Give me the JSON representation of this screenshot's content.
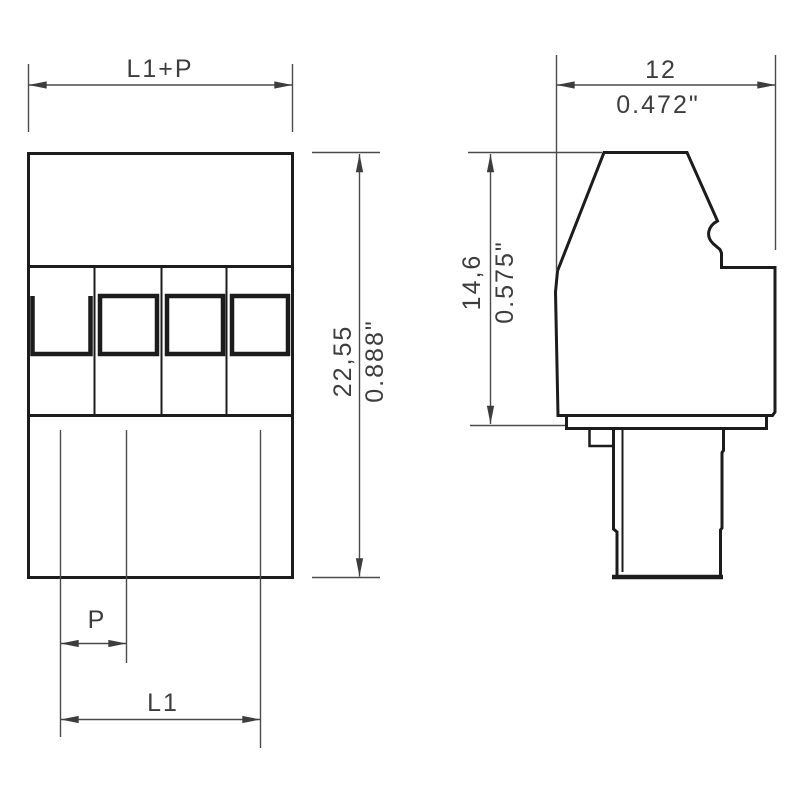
{
  "drawing_type": "dimension-drawing",
  "front_view": {
    "width_label": "L1+P",
    "height_mm": "22,55",
    "height_inch": "0.888\"",
    "pitch": "P",
    "length": "L1"
  },
  "side_view": {
    "width_mm": "12",
    "width_inch": "0.472\"",
    "height_mm": "14,6",
    "height_inch": "0.575\""
  },
  "colors": {
    "background": "#ffffff",
    "outline": "#1c1c1c",
    "dimension_line": "#4b4b4b",
    "text": "#3d3d3d"
  }
}
